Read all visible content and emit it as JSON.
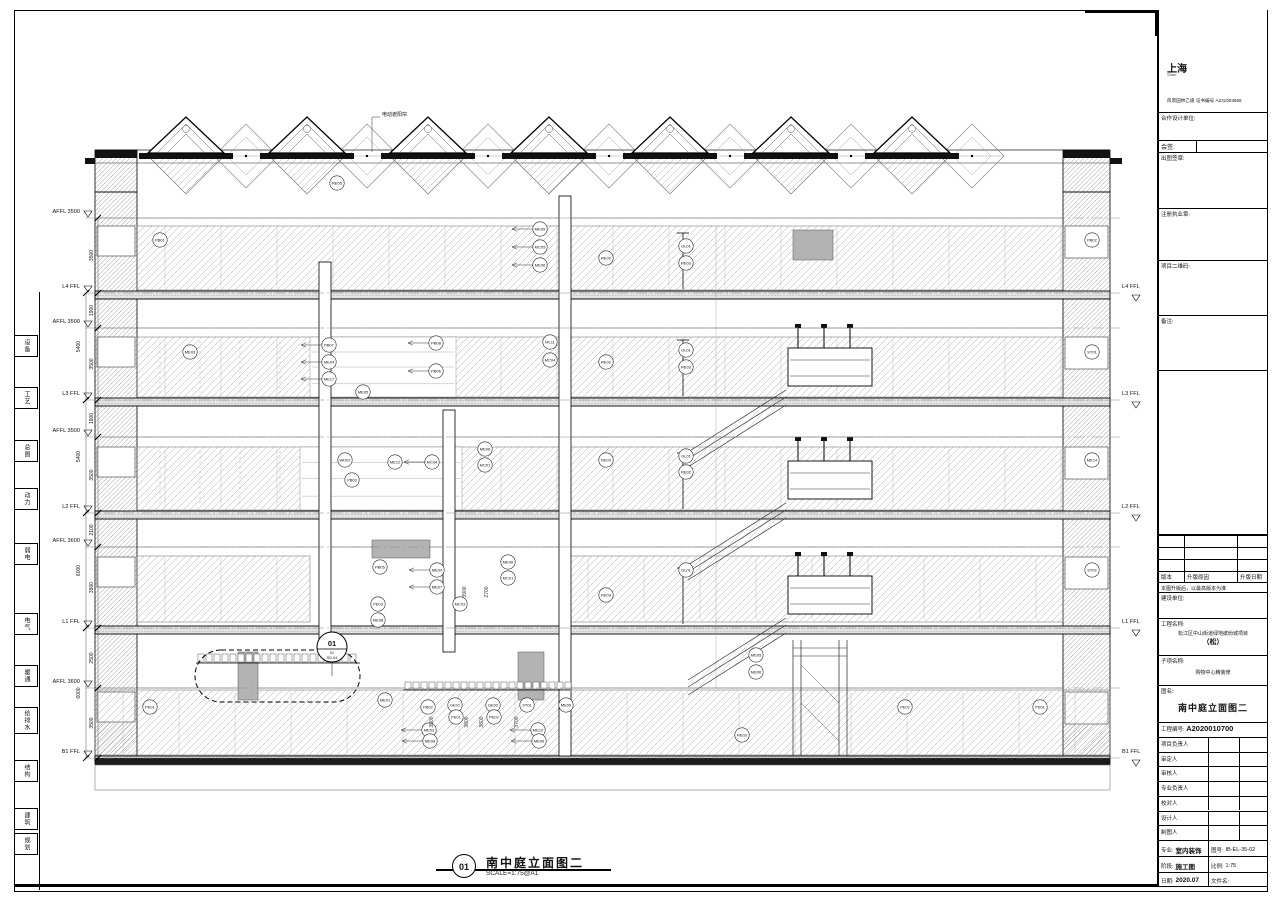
{
  "doc": {
    "view_title": {
      "num": "01",
      "name": "南中庭立面图二",
      "scale": "SCALE=1:75@A1"
    },
    "sunshade_label": "电动遮阳帘",
    "callout": {
      "num": "01",
      "ref1": "ID",
      "ref2": "SD-04"
    }
  },
  "margin_disciplines": [
    {
      "label": "设备",
      "top": 335
    },
    {
      "label": "工艺",
      "top": 387
    },
    {
      "label": "总图",
      "top": 440
    },
    {
      "label": "动力",
      "top": 488
    },
    {
      "label": "弱电",
      "top": 543
    },
    {
      "label": "电气",
      "top": 613
    },
    {
      "label": "暖通",
      "top": 665
    },
    {
      "label": "给排水",
      "top": 707,
      "h": 27
    },
    {
      "label": "结构",
      "top": 760
    },
    {
      "label": "建筑",
      "top": 808
    },
    {
      "label": "规划",
      "top": 833
    }
  ],
  "levels": [
    {
      "label": "AFFL 3500",
      "y": 218,
      "right": ""
    },
    {
      "label": "L4 FFL",
      "y": 293,
      "right": "L4 FFL"
    },
    {
      "label": "AFFL 3500",
      "y": 328,
      "right": ""
    },
    {
      "label": "L3 FFL",
      "y": 400,
      "right": "L3 FFL"
    },
    {
      "label": "AFFL 3500",
      "y": 437,
      "right": ""
    },
    {
      "label": "L2 FFL",
      "y": 513,
      "right": "L2 FFL"
    },
    {
      "label": "AFFL 3600",
      "y": 547,
      "right": ""
    },
    {
      "label": "L1 FFL",
      "y": 628,
      "right": "L1 FFL"
    },
    {
      "label": "AFFL 3600",
      "y": 688,
      "right": ""
    },
    {
      "label": "B1 FFL",
      "y": 758,
      "right": "B1 FFL"
    }
  ],
  "dims": {
    "outer": [
      {
        "v": "5400",
        "y1": 293,
        "y2": 400
      },
      {
        "v": "5400",
        "y1": 400,
        "y2": 513
      },
      {
        "v": "6000",
        "y1": 513,
        "y2": 628
      },
      {
        "v": "6000",
        "y1": 628,
        "y2": 758
      }
    ],
    "inner": [
      {
        "v": "3500",
        "y1": 218,
        "y2": 293
      },
      {
        "v": "1900",
        "y1": 293,
        "y2": 328
      },
      {
        "v": "3500",
        "y1": 328,
        "y2": 400
      },
      {
        "v": "1900",
        "y1": 400,
        "y2": 437
      },
      {
        "v": "3500",
        "y1": 437,
        "y2": 513
      },
      {
        "v": "2100",
        "y1": 513,
        "y2": 547
      },
      {
        "v": "3900",
        "y1": 547,
        "y2": 628
      },
      {
        "v": "2500",
        "y1": 628,
        "y2": 688
      },
      {
        "v": "3500",
        "y1": 688,
        "y2": 758
      }
    ]
  },
  "dim_texts": [
    {
      "v": "3500",
      "x": 433,
      "y": 722
    },
    {
      "v": "3800",
      "x": 468,
      "y": 722
    },
    {
      "v": "3600",
      "x": 483,
      "y": 722
    },
    {
      "v": "3700",
      "x": 518,
      "y": 722
    },
    {
      "v": "3900",
      "x": 466,
      "y": 592
    },
    {
      "v": "2700",
      "x": 488,
      "y": 592
    }
  ],
  "tags": [
    {
      "c": "RE05",
      "x": 337,
      "y": 183
    },
    {
      "c": "ME05",
      "x": 540,
      "y": 229,
      "l": 1
    },
    {
      "c": "MC05",
      "x": 540,
      "y": 247,
      "l": 1
    },
    {
      "c": "ME06",
      "x": 540,
      "y": 265,
      "l": 1
    },
    {
      "c": "RE02",
      "x": 606,
      "y": 258
    },
    {
      "c": "GL01",
      "x": 686,
      "y": 246
    },
    {
      "c": "RE03",
      "x": 686,
      "y": 263
    },
    {
      "c": "PB02",
      "x": 1092,
      "y": 240
    },
    {
      "c": "PB01",
      "x": 160,
      "y": 240
    },
    {
      "c": "PB07",
      "x": 329,
      "y": 345,
      "l": 1
    },
    {
      "c": "ME04",
      "x": 329,
      "y": 362,
      "l": 1
    },
    {
      "c": "ME17",
      "x": 329,
      "y": 379,
      "l": 1
    },
    {
      "c": "PB08",
      "x": 436,
      "y": 343,
      "l": 1
    },
    {
      "c": "PB06",
      "x": 436,
      "y": 371,
      "l": 1
    },
    {
      "c": "ME05",
      "x": 363,
      "y": 392
    },
    {
      "c": "ML11",
      "x": 550,
      "y": 342
    },
    {
      "c": "MC04",
      "x": 550,
      "y": 360
    },
    {
      "c": "RE02",
      "x": 606,
      "y": 362
    },
    {
      "c": "GL01",
      "x": 686,
      "y": 350
    },
    {
      "c": "RE03",
      "x": 686,
      "y": 367
    },
    {
      "c": "ME03",
      "x": 190,
      "y": 352
    },
    {
      "c": "ST01",
      "x": 1092,
      "y": 352
    },
    {
      "c": "WD02",
      "x": 345,
      "y": 460
    },
    {
      "c": "ME12",
      "x": 395,
      "y": 462
    },
    {
      "c": "MC04",
      "x": 432,
      "y": 462,
      "l": 1
    },
    {
      "c": "ME06",
      "x": 485,
      "y": 449
    },
    {
      "c": "MC01",
      "x": 485,
      "y": 465
    },
    {
      "c": "RE03",
      "x": 606,
      "y": 460
    },
    {
      "c": "GL01",
      "x": 686,
      "y": 456
    },
    {
      "c": "RE02",
      "x": 686,
      "y": 472
    },
    {
      "c": "PB03",
      "x": 352,
      "y": 480
    },
    {
      "c": "ME14",
      "x": 1092,
      "y": 460
    },
    {
      "c": "PB05",
      "x": 380,
      "y": 567
    },
    {
      "c": "ME04",
      "x": 437,
      "y": 570,
      "l": 1
    },
    {
      "c": "ME06",
      "x": 508,
      "y": 562
    },
    {
      "c": "MC01",
      "x": 508,
      "y": 578
    },
    {
      "c": "ME07",
      "x": 437,
      "y": 587,
      "l": 1
    },
    {
      "c": "RE03",
      "x": 606,
      "y": 595
    },
    {
      "c": "GL01",
      "x": 686,
      "y": 570
    },
    {
      "c": "PE03",
      "x": 378,
      "y": 604
    },
    {
      "c": "ME08",
      "x": 378,
      "y": 620
    },
    {
      "c": "MC03",
      "x": 460,
      "y": 604
    },
    {
      "c": "ST02",
      "x": 1092,
      "y": 570
    },
    {
      "c": "ME05",
      "x": 756,
      "y": 655
    },
    {
      "c": "ME06",
      "x": 756,
      "y": 672
    },
    {
      "c": "PE01",
      "x": 150,
      "y": 707
    },
    {
      "c": "ME01",
      "x": 385,
      "y": 700
    },
    {
      "c": "PB02",
      "x": 428,
      "y": 707
    },
    {
      "c": "GE01",
      "x": 455,
      "y": 705
    },
    {
      "c": "PE01",
      "x": 456,
      "y": 717
    },
    {
      "c": "GE02",
      "x": 493,
      "y": 705
    },
    {
      "c": "PE02",
      "x": 494,
      "y": 717
    },
    {
      "c": "ST01",
      "x": 527,
      "y": 705
    },
    {
      "c": "ME09",
      "x": 566,
      "y": 705
    },
    {
      "c": "ME03",
      "x": 429,
      "y": 730,
      "l": 1
    },
    {
      "c": "ME08",
      "x": 430,
      "y": 741,
      "l": 1
    },
    {
      "c": "ME10",
      "x": 538,
      "y": 730,
      "l": 1
    },
    {
      "c": "ME06",
      "x": 539,
      "y": 741,
      "l": 1
    },
    {
      "c": "RE03",
      "x": 742,
      "y": 735
    },
    {
      "c": "PE02",
      "x": 905,
      "y": 707
    },
    {
      "c": "PE01",
      "x": 1040,
      "y": 707
    }
  ],
  "titleblock": {
    "logo_cn": "上海",
    "logo_en": "Shan",
    "cert_line": "风景园林乙级 证书编号 A231003666",
    "fields": {
      "cooperative": "合作设计单位:",
      "countersign": "会签:",
      "plot_seal": "出图签章:",
      "register_seal": "注册执业章:",
      "qr": "项目二维码:",
      "remark": "备注:",
      "version": "版本",
      "reason": "升版原因",
      "update_date": "升版日期",
      "version_note": "本图升版后，以最高版本为准",
      "client": "建设单位:",
      "project_label": "工程名称:",
      "project_name1": "松江区中山街道绿地缤纷城项目",
      "project_name2": "（松）",
      "subproject_label": "子项名称:",
      "subproject_name": "购物中心精装修",
      "drawing_label": "图名:",
      "drawing_name": "南中庭立面图二",
      "project_no_label": "工程编号:",
      "project_no": "A2020010700",
      "personnel": [
        "项目负责人",
        "审定人",
        "审核人",
        "专业负责人",
        "校对人",
        "设计人",
        "制图人"
      ],
      "major_label": "专业:",
      "major": "室内装饰",
      "dwgno_label": "图号:",
      "dwgno": "IB-EL-35-02",
      "stage_label": "阶段:",
      "stage": "施工图",
      "scale_label": "比例:",
      "scale": "1:75",
      "date_label": "日期:",
      "date": "2020.07",
      "file_label": "文件名:",
      "file": ""
    }
  }
}
